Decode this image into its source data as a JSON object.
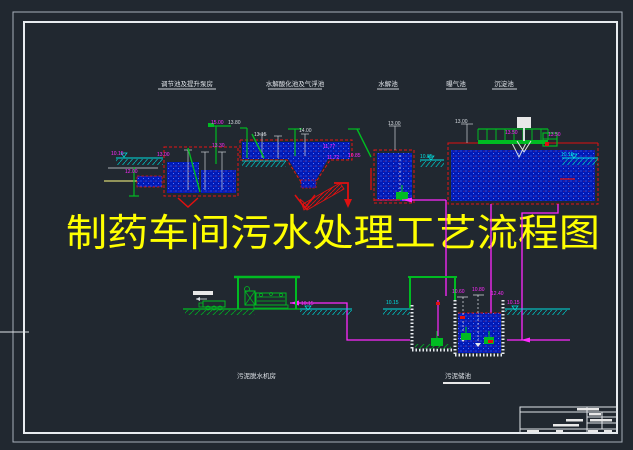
{
  "app": {
    "type": "cad-drawing-viewer",
    "background": "#212830"
  },
  "title": {
    "text": "制药车间污水处理工艺流程图",
    "color": "#ffff00"
  },
  "section_labels": [
    {
      "text": "调节池及提升泵房"
    },
    {
      "text": "水解酸化池及气浮池"
    },
    {
      "text": "水解池"
    },
    {
      "text": "曝气池"
    },
    {
      "text": "沉淀池"
    }
  ],
  "captions": {
    "left": "污泥脱水机房",
    "right": "污泥储池"
  },
  "elevations": [
    {
      "text": "10.15"
    },
    {
      "text": "12.00"
    },
    {
      "text": "13.00"
    },
    {
      "text": "13.30"
    },
    {
      "text": "15.00"
    },
    {
      "text": "13.80"
    },
    {
      "text": "13.15"
    },
    {
      "text": "14.00"
    },
    {
      "text": "11.77"
    },
    {
      "text": "11.72"
    },
    {
      "text": "10.85"
    },
    {
      "text": "13.00"
    },
    {
      "text": "10.85"
    },
    {
      "text": "13.00"
    },
    {
      "text": "13.50"
    },
    {
      "text": "13.50"
    },
    {
      "text": "10.15"
    },
    {
      "text": "10.15"
    },
    {
      "text": "10.15"
    },
    {
      "text": "10.60"
    },
    {
      "text": "10.80"
    },
    {
      "text": "12.40"
    },
    {
      "text": "10.15"
    }
  ],
  "colors": {
    "water_blue": "#001bb8",
    "wall_red": "#e81414",
    "pipe_magenta": "#ff29ff",
    "equipment_green": "#00bb22",
    "waterline_cyan": "#00e0e0",
    "dimension_white": "#d8dde2",
    "frame_white": "#e8ecf0",
    "title_yellow": "#ffff00"
  }
}
